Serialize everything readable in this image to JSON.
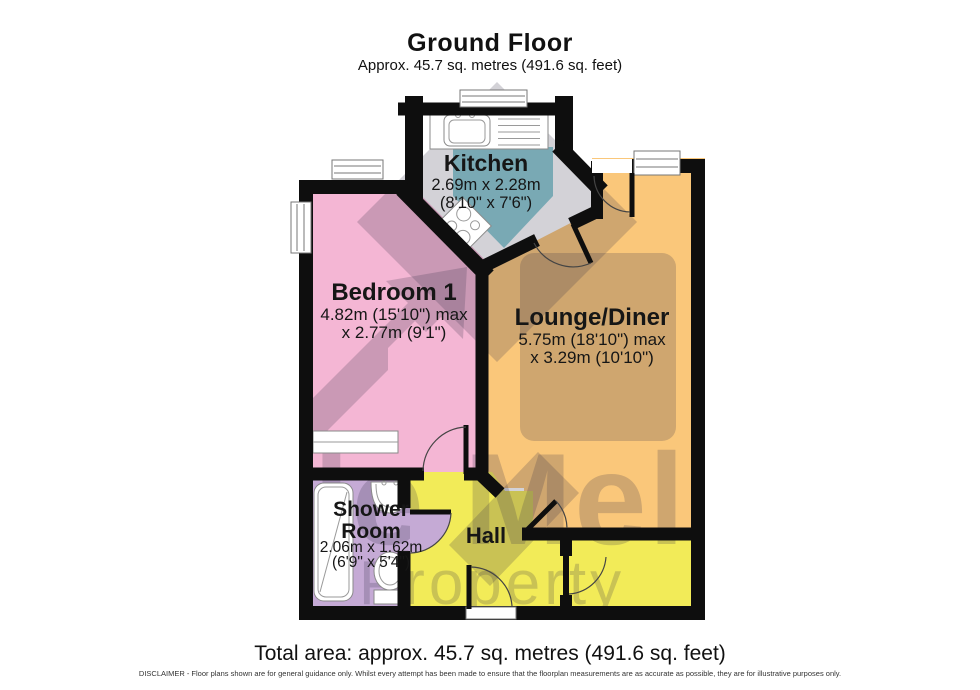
{
  "header": {
    "title": "Ground Floor",
    "subtitle": "Approx. 45.7 sq. metres (491.6 sq. feet)"
  },
  "rooms": {
    "kitchen": {
      "name": "Kitchen",
      "dim_metric": "2.69m x 2.28m",
      "dim_imperial": "(8'10\" x 7'6\")"
    },
    "bedroom": {
      "name": "Bedroom 1",
      "dim_line1": "4.82m (15'10\") max",
      "dim_line2": "x 2.77m (9'1\")"
    },
    "lounge": {
      "name": "Lounge/Diner",
      "dim_line1": "5.75m (18'10\") max",
      "dim_line2": "x 3.29m (10'10\")"
    },
    "shower": {
      "name_line1": "Shower",
      "name_line2": "Room",
      "dim_line1": "2.06m x 1.62m",
      "dim_line2": "(6'9\" x 5'4\")"
    },
    "hall": {
      "name": "Hall"
    }
  },
  "watermark": {
    "line1": "le Mel",
    "line2": "Property"
  },
  "footer": {
    "total_area": "Total area: approx. 45.7 sq. metres (491.6 sq. feet)",
    "disclaimer": "DISCLAIMER -  Floor plans shown are for general guidance only. Whilst every attempt has been made to ensure that the floorplan measurements are as accurate as possible, they are for illustrative purposes only."
  },
  "colors": {
    "wall": "#0e0e0e",
    "kitchen_floor": "#8ccbd3",
    "bedroom_floor": "#f4b6d4",
    "lounge_floor": "#fac77a",
    "shower_floor": "#c5aad5",
    "hall_floor": "#f2eb58",
    "watermark": "rgba(55,50,75,0.22)"
  }
}
